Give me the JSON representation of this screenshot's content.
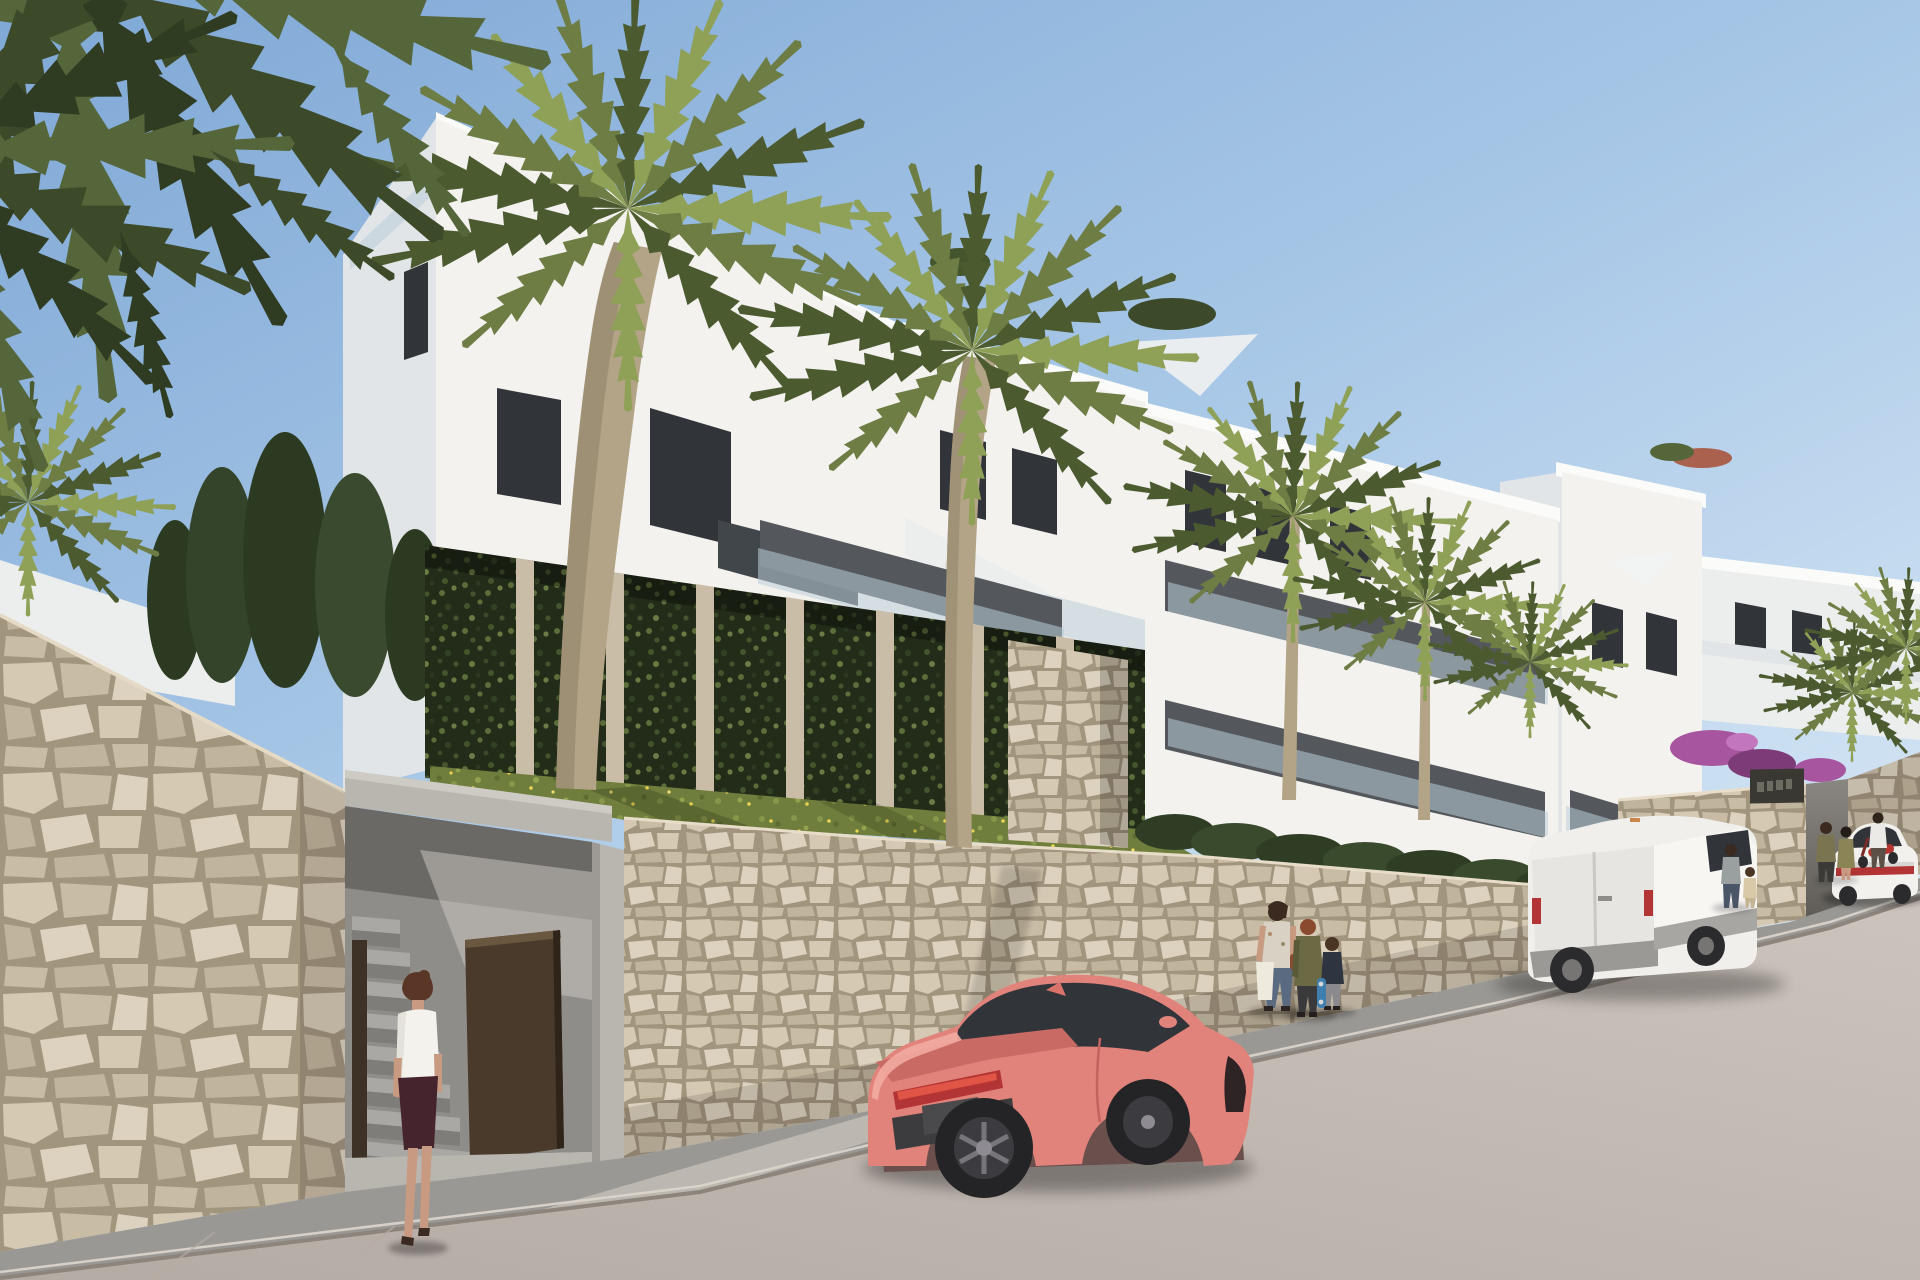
{
  "meta": {
    "title": "Street-level architectural render of a new-build white apartment complex on a hillside, with palm trees, natural stone retaining walls, a pedestrian entrance, parked coral sports coupe and white delivery van, and pedestrians on the sidewalk"
  },
  "palette": {
    "sky_top": "#7fa8d6",
    "sky_mid": "#a9c8e7",
    "sky_low": "#ddebf7",
    "building_lit": "#f3f2ef",
    "building_lit2": "#eceeee",
    "building_shade": "#e2e5e7",
    "building_dark": "#cdd1d5",
    "roof_slab": "#fbfbf9",
    "glass_dark": "#31353a",
    "railing_glass": "#b9cdd8",
    "concrete": "#b9b6b0",
    "concrete_shade": "#8f8d89",
    "concrete_dark": "#6e6c68",
    "door_brown": "#4a3a2b",
    "ivy_dark": "#222c19",
    "grass_base": "#6f7e3c",
    "flower_yellow": "#e8d44f",
    "palm_dark": "#4c5a30",
    "palm_mid": "#6d7d44",
    "palm_light": "#8fa057",
    "palm_over1": "#3d4a2a",
    "palm_over2": "#55663a",
    "palm_over3": "#2f3c22",
    "trunk": "#b4a487",
    "trunk_shade": "#8c7f66",
    "stone_mortar": "#a2957e",
    "stone_1": "#d5c9b4",
    "stone_2": "#c9bca5",
    "stone_3": "#ddd2bf",
    "stone_4": "#c1b49c",
    "road_near": "#b5aba5",
    "road_far": "#cbc3bc",
    "sidewalk": "#9a9894",
    "curb": "#8d847c",
    "car_coral": "#e2837b",
    "car_coral_dark": "#b65f5b",
    "car_coral_light": "#f2aba1",
    "taillight_red": "#b23434",
    "van_white": "#f0efec",
    "van_shade": "#dfdedb",
    "bougainvillea": "#a855a0",
    "skin": "#c89a82"
  },
  "scene": {
    "sky": {
      "label": "clear pale-blue sky, brighter toward the right horizon"
    },
    "complex": {
      "label": "terraced white modern apartment buildings with flat roofs, balconies and glass railings"
    },
    "trellis": {
      "label": "green ivy trellis panels with stone pillars at the building base"
    },
    "lawn": {
      "label": "sloped lawn dotted with yellow wildflowers"
    },
    "retaining_wall": {
      "label": "cream natural-stone retaining wall along the street"
    },
    "foreground_wall": {
      "label": "tall natural-stone wall in the left foreground"
    },
    "entrance": {
      "label": "recessed pedestrian entrance with concrete stairs and an open dark-brown gate",
      "sign": {
        "label": "dark entrance plaque on stone wall (lettering not legible)",
        "text": ""
      }
    },
    "gate_area": {
      "label": "vehicle ramp entrance between stone walls at far right"
    },
    "street": {
      "label": "curving asphalt street with sidewalk descending to the left"
    },
    "palms": {
      "label": "tall fan palms in front of the facade and overhanging fronds at top left"
    },
    "vehicles": {
      "coupe": {
        "label": "coral-pink sports coupe parked at the curb",
        "color": "#e2837b"
      },
      "van": {
        "label": "white panel van parked farther up the street",
        "color": "#f0efec"
      },
      "sedan": {
        "label": "white sedan on the road at far right"
      },
      "scooter": {
        "label": "red scooter with rider near the gate"
      }
    },
    "people": [
      {
        "label": "woman in white blouse and dark skirt walking into the entrance"
      },
      {
        "label": "woman with shopping bags walking on the sidewalk"
      },
      {
        "label": "teenager in olive jacket walking on the sidewalk"
      },
      {
        "label": "child carrying a blue skateboard"
      },
      {
        "label": "man walking with a small child near the van"
      },
      {
        "label": "couple standing by the gate entrance"
      }
    ]
  }
}
